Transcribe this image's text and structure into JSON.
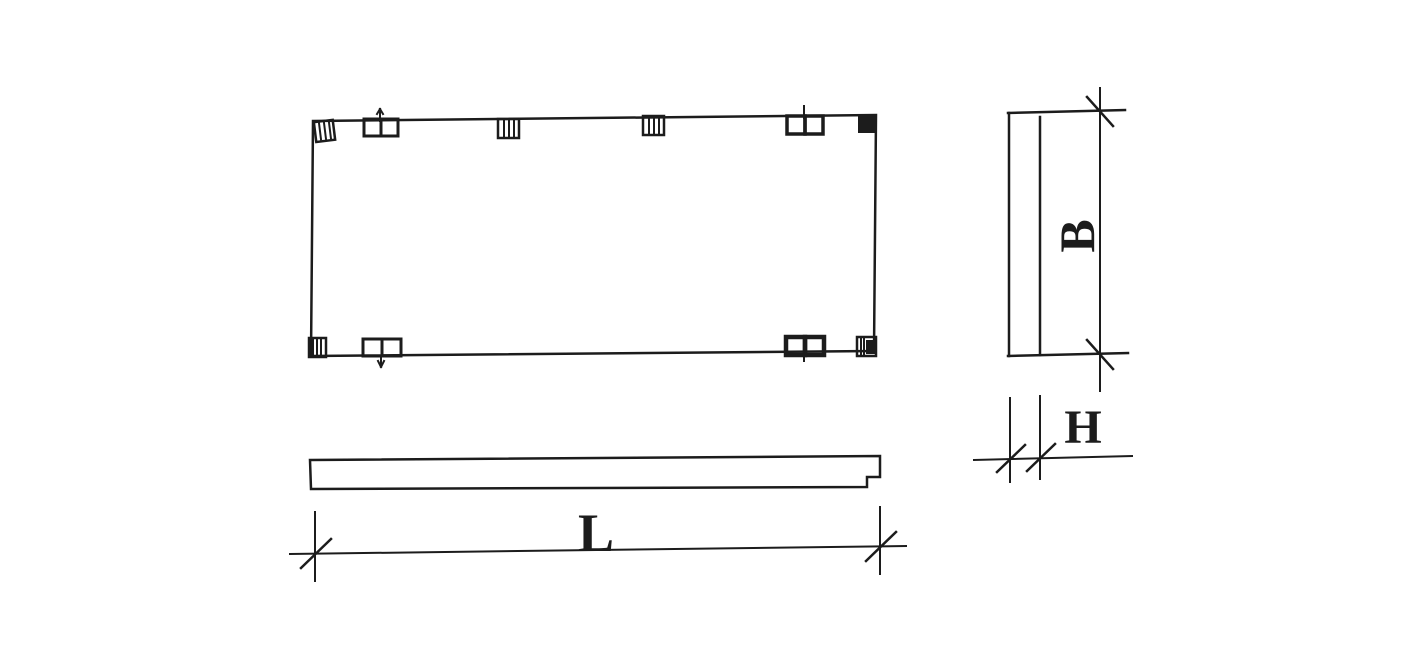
{
  "figure": {
    "type": "technical-drawing",
    "labels": {
      "length": "L",
      "width": "B",
      "thickness": "H"
    },
    "colors": {
      "line": "#1c1c1c",
      "background": "#ffffff"
    }
  }
}
